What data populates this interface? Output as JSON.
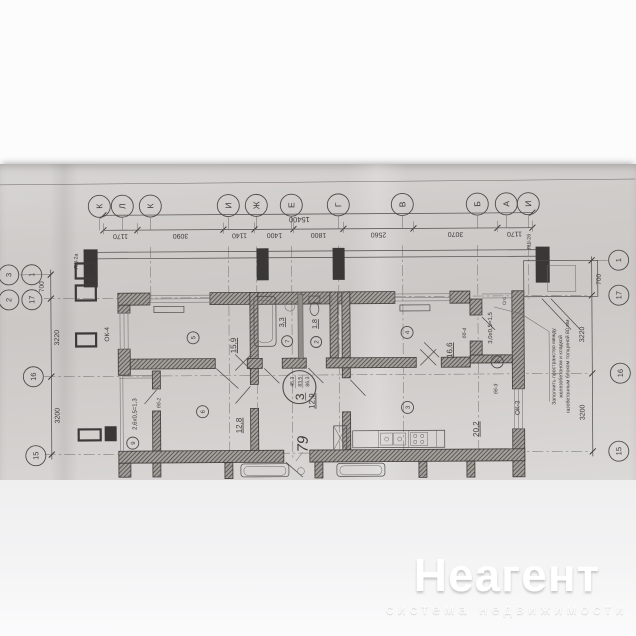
{
  "watermark": {
    "title": "Неагент",
    "subtitle": "система недвижимости"
  },
  "plan": {
    "top_axis_letters": [
      "К",
      "Л",
      "К",
      "И",
      "Ж",
      "Е",
      "Г",
      "В",
      "Б",
      "А",
      "И"
    ],
    "top_dims": [
      "1170",
      "3090",
      "1140",
      "1400",
      "1800",
      "2560",
      "3070",
      "1170"
    ],
    "top_total": "15400",
    "left_axes": [
      "3",
      "1",
      "2",
      "17",
      "16",
      "15"
    ],
    "right_axes": [
      "1",
      "17",
      "16",
      "15"
    ],
    "left_dims": [
      "700",
      "3220",
      "3200"
    ],
    "right_dims": [
      "700",
      "3220",
      "3200"
    ],
    "rooms": {
      "room5": {
        "number": "5",
        "area": "15,9"
      },
      "room6": {
        "number": "6",
        "area": "12,8"
      },
      "room4": {
        "number": "4",
        "area": "16,6"
      },
      "kitchen": {
        "number": "3",
        "area": "20,2"
      },
      "hall": {
        "area": "12,9"
      },
      "bath": {
        "number": "7",
        "area": "3,3"
      },
      "wc": {
        "number": "2",
        "area": "1,8"
      },
      "balcony9": {
        "number": "9",
        "area": "2,6х0,5=1,3"
      },
      "balcony8": {
        "number": "8",
        "area": "3,0х0,5=1,5"
      }
    },
    "apartment": {
      "number": "79",
      "rooms": "3",
      "living_area": "45,3",
      "area": "83,5",
      "total_area": "86,3"
    },
    "marks": {
      "ok4": "ОК-4",
      "ok3": "ОК-3",
      "lsh2a": "ЛШ-2а",
      "lsh2b": "ЛШ-2б",
      "bb2": "бб-2",
      "bb3": "бб-3",
      "bb4": "бб-4",
      "sp1": "Сп1"
    },
    "note": {
      "line1": "Заполнить пространство между",
      "line2": "железобетоном и кладкой",
      "line3": "газобетонным блоком толщиной 80 мм"
    }
  }
}
